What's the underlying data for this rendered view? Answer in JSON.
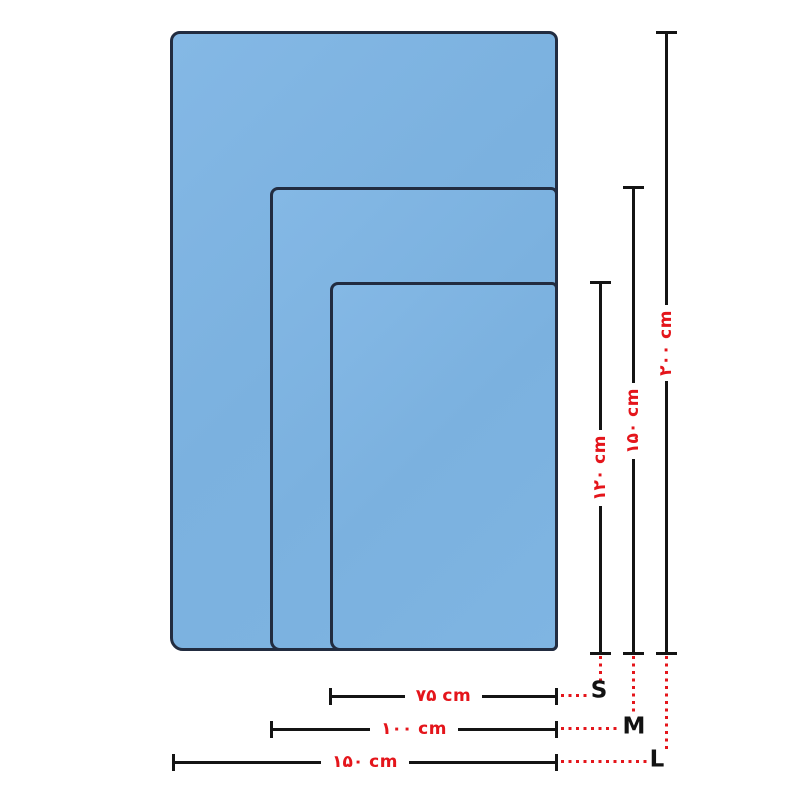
{
  "diagram": {
    "unit": "cm",
    "sizes": [
      {
        "label": "S",
        "width_label": "۷۵ cm",
        "height_label": "۱۲۰ cm",
        "width_cm": 75,
        "height_cm": 120
      },
      {
        "label": "M",
        "width_label": "۱۰۰ cm",
        "height_label": "۱۵۰ cm",
        "width_cm": 100,
        "height_cm": 150
      },
      {
        "label": "L",
        "width_label": "۱۵۰ cm",
        "height_label": "۲۰۰ cm",
        "width_cm": 150,
        "height_cm": 200
      }
    ],
    "colors": {
      "towel_fill": "#7db3e0",
      "towel_border": "#222c40",
      "dimension_line": "#141414",
      "accent_red": "#e4151b",
      "background": "#ffffff"
    }
  }
}
